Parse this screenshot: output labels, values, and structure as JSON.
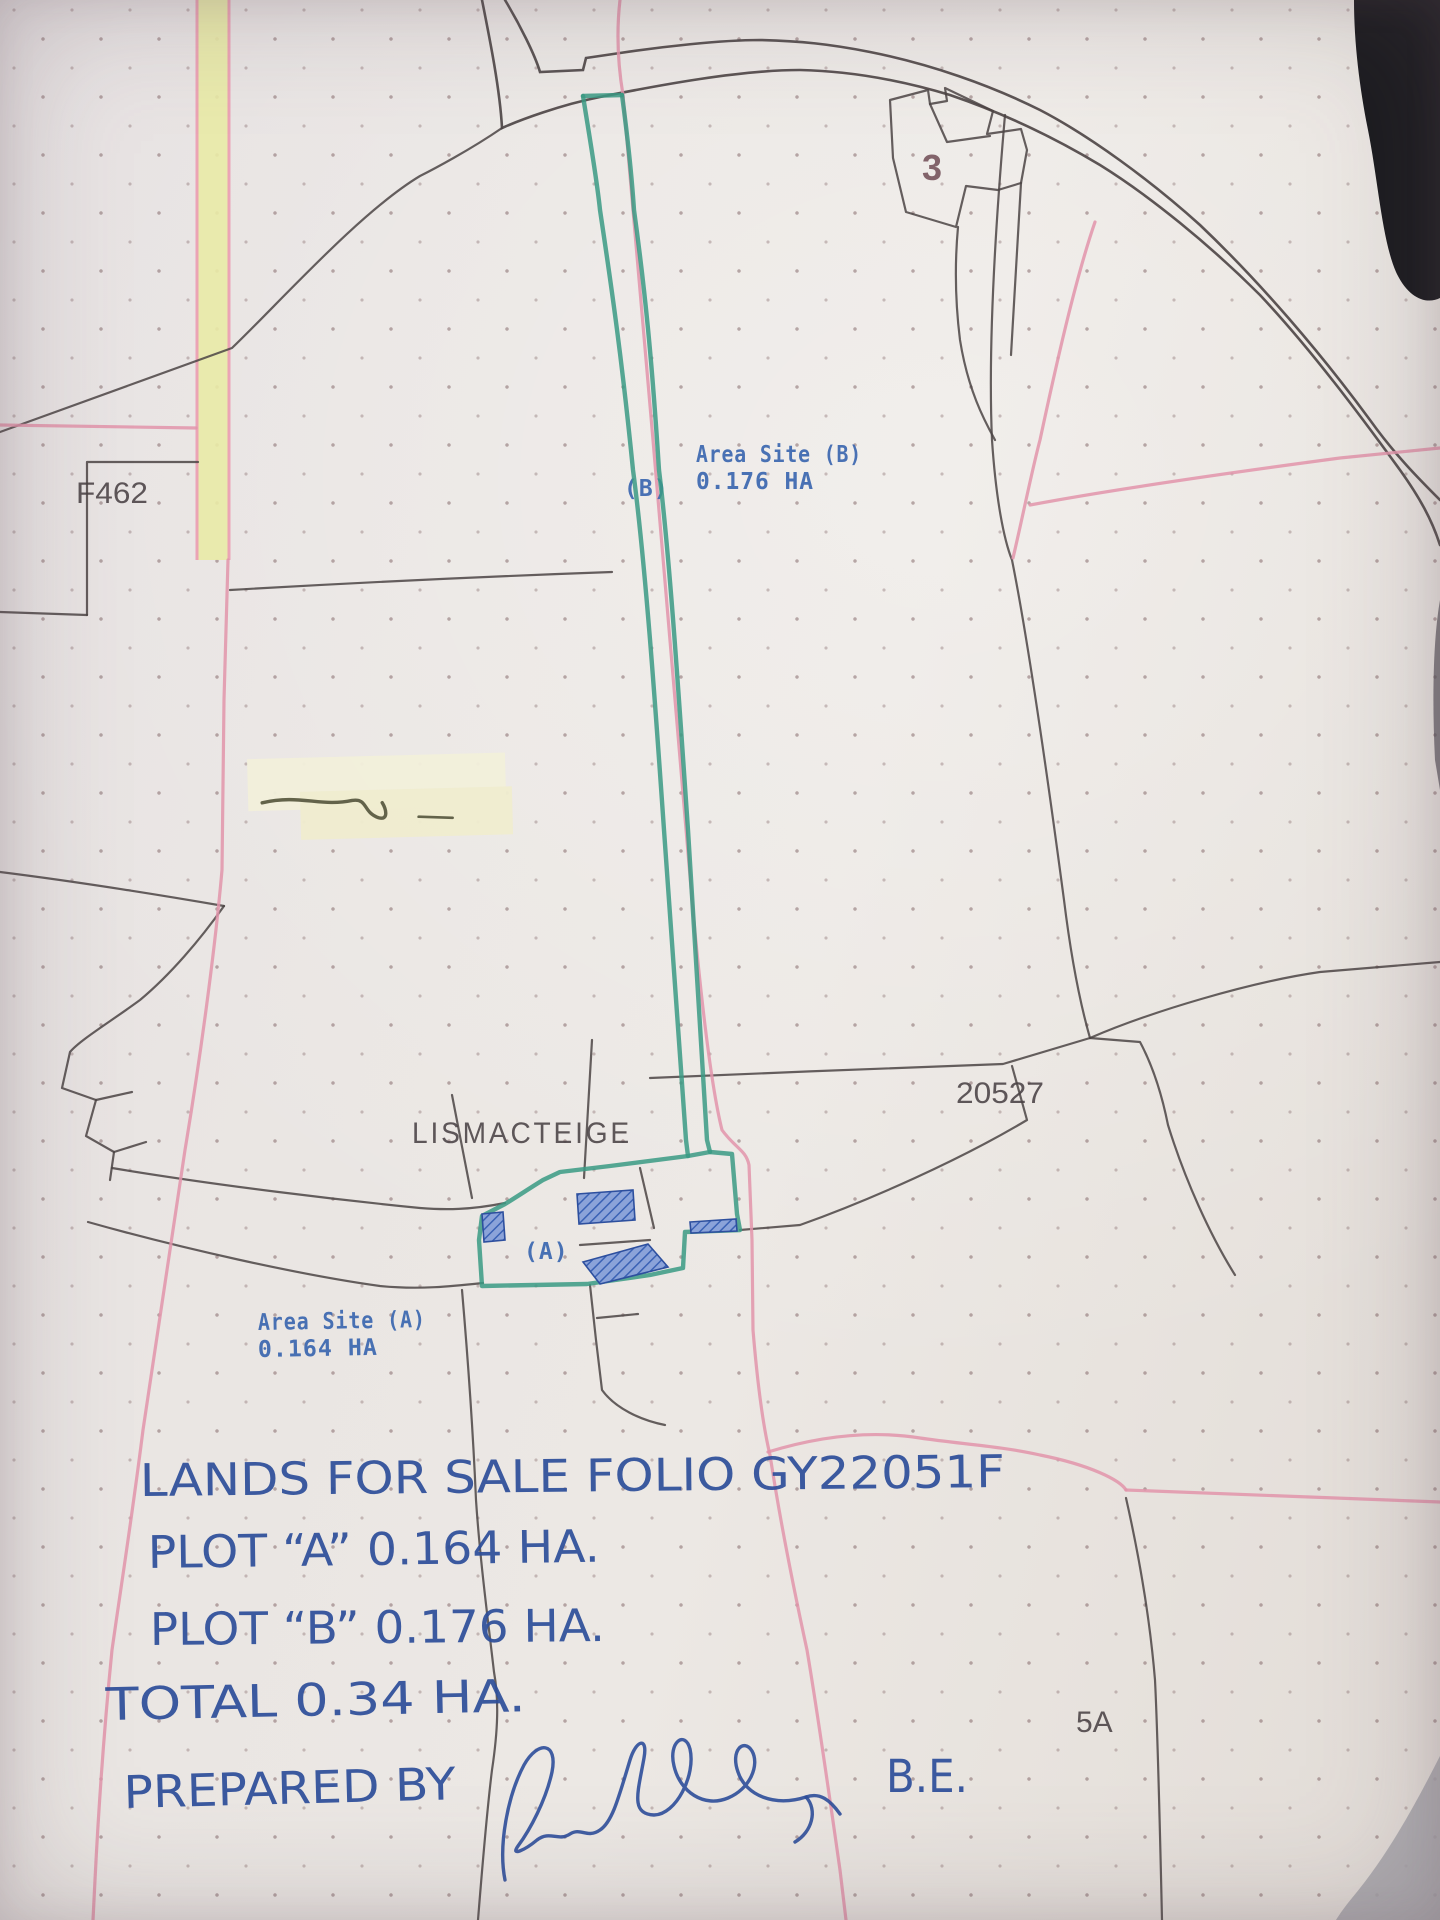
{
  "map": {
    "townland": "LISMACTEIGE",
    "parcel_labels": {
      "f462": "F462",
      "plan_20527": "20527",
      "plot_5a": "5A",
      "building_3": "3"
    },
    "site_a": {
      "marker": "(A)",
      "title": "Area Site (A)",
      "area": "0.164 HA"
    },
    "site_b": {
      "marker": "(B)",
      "title": "Area Site (B)",
      "area": "0.176 HA"
    }
  },
  "handwriting": {
    "line1": "LANDS FOR SALE FOLIO GY22051F",
    "line2": "PLOT “A” 0.164 HA.",
    "line3": "PLOT “B” 0.176 HA.",
    "line4": "TOTAL 0.34 HA.",
    "prepared_by": "PREPARED BY",
    "credentials": "B.E."
  },
  "colors": {
    "paper": "#e9e5e2",
    "plot_outline_green": "#3a9a84",
    "building_blue": "#6f8fd2",
    "typed_blue": "#3b67b0",
    "ink_blue": "#2d4e9a",
    "boundary_black": "#4b4444",
    "boundary_pink": "#e294aa",
    "highlight_yellow": "#e9eaa6"
  }
}
